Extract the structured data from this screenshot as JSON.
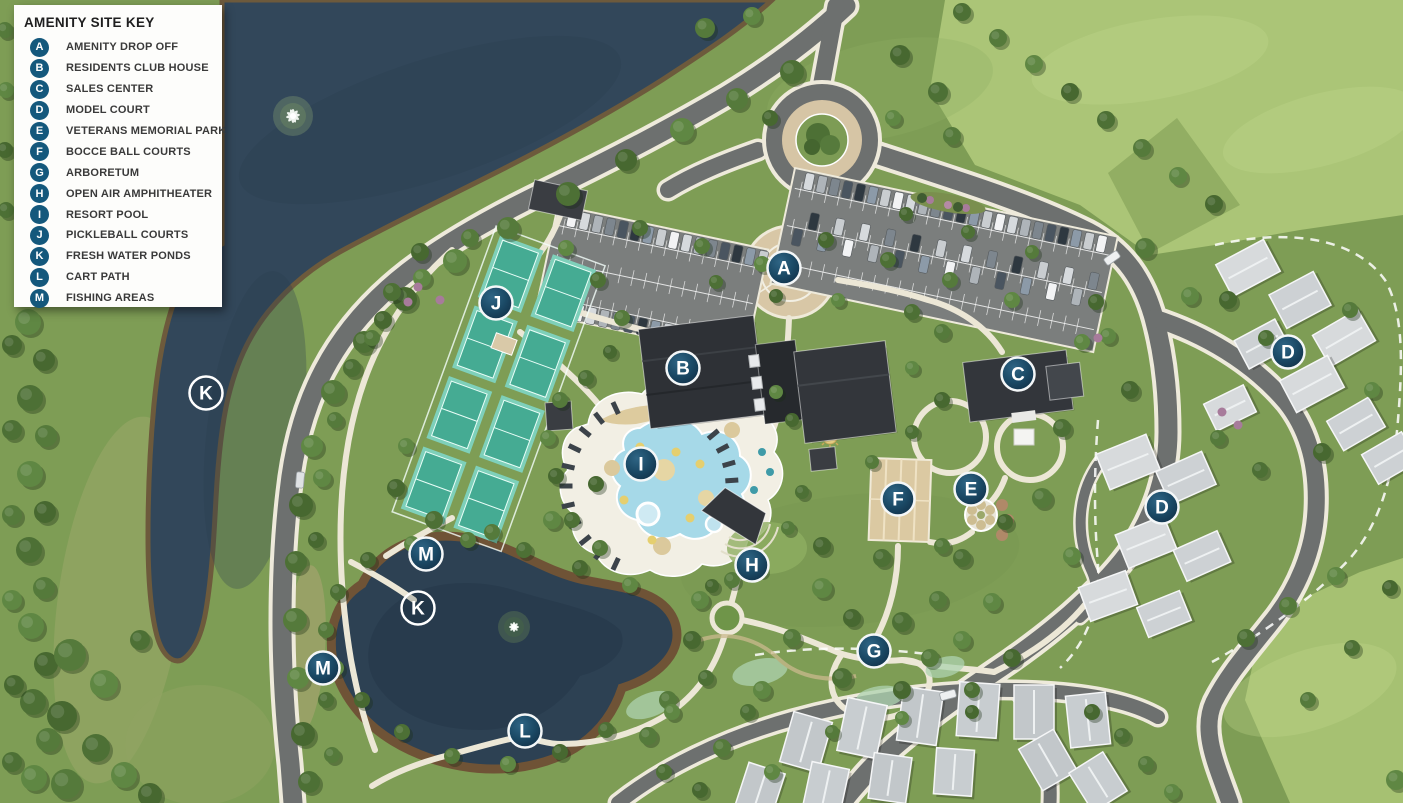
{
  "legend": {
    "title": "AMENITY SITE KEY",
    "items": [
      {
        "letter": "A",
        "label": "AMENITY DROP OFF"
      },
      {
        "letter": "B",
        "label": "RESIDENTS CLUB HOUSE"
      },
      {
        "letter": "C",
        "label": "SALES CENTER"
      },
      {
        "letter": "D",
        "label": "MODEL COURT"
      },
      {
        "letter": "E",
        "label": "VETERANS MEMORIAL PARK"
      },
      {
        "letter": "F",
        "label": "BOCCE BALL COURTS"
      },
      {
        "letter": "G",
        "label": "ARBORETUM"
      },
      {
        "letter": "H",
        "label": "OPEN AIR AMPHITHEATER"
      },
      {
        "letter": "I",
        "label": "RESORT POOL"
      },
      {
        "letter": "J",
        "label": "PICKLEBALL COURTS"
      },
      {
        "letter": "K",
        "label": "FRESH WATER PONDS"
      },
      {
        "letter": "L",
        "label": "CART PATH"
      },
      {
        "letter": "M",
        "label": "FISHING AREAS"
      }
    ]
  },
  "markers": [
    {
      "letter": "A",
      "x": 784,
      "y": 268,
      "variant": "solid"
    },
    {
      "letter": "B",
      "x": 683,
      "y": 368,
      "variant": "solid"
    },
    {
      "letter": "C",
      "x": 1018,
      "y": 374,
      "variant": "solid"
    },
    {
      "letter": "D",
      "x": 1288,
      "y": 352,
      "variant": "solid"
    },
    {
      "letter": "D",
      "x": 1162,
      "y": 507,
      "variant": "solid"
    },
    {
      "letter": "E",
      "x": 971,
      "y": 489,
      "variant": "solid"
    },
    {
      "letter": "F",
      "x": 898,
      "y": 499,
      "variant": "solid"
    },
    {
      "letter": "G",
      "x": 874,
      "y": 651,
      "variant": "solid"
    },
    {
      "letter": "H",
      "x": 752,
      "y": 565,
      "variant": "solid"
    },
    {
      "letter": "I",
      "x": 641,
      "y": 464,
      "variant": "solid"
    },
    {
      "letter": "J",
      "x": 496,
      "y": 303,
      "variant": "solid"
    },
    {
      "letter": "K",
      "x": 206,
      "y": 393,
      "variant": "outline"
    },
    {
      "letter": "K",
      "x": 418,
      "y": 608,
      "variant": "outline"
    },
    {
      "letter": "L",
      "x": 525,
      "y": 731,
      "variant": "solid"
    },
    {
      "letter": "M",
      "x": 426,
      "y": 554,
      "variant": "solid"
    },
    {
      "letter": "M",
      "x": 323,
      "y": 668,
      "variant": "solid"
    }
  ],
  "colors": {
    "marker_fill": "#1c4a66",
    "marker_ring": "#ffffff",
    "legend_badge": "#14587c",
    "water": "#32475a",
    "grass": "#7e9d55",
    "field": "#abc577",
    "road": "#6d706f",
    "walk_path": "#ece7d6",
    "pickleball_court": "#45ab93",
    "pool_water": "#a6d9e8",
    "bocce_tan": "#dbc9a2",
    "building_roof": "#33363b"
  }
}
